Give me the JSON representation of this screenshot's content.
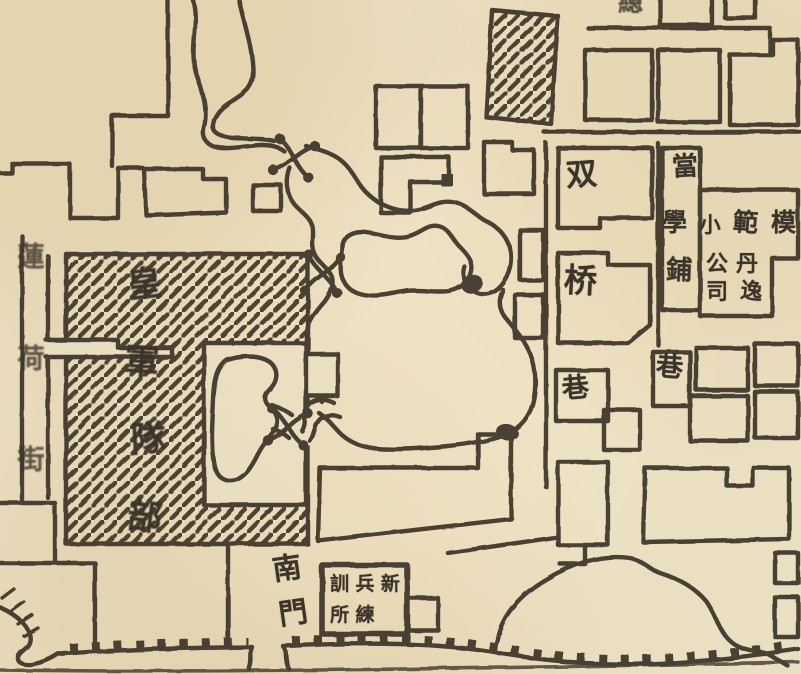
{
  "palette": {
    "paper": "#ebdfc2",
    "ink": "#3e352a"
  },
  "labels": {
    "army_hq": {
      "chars": [
        "皇",
        "軍",
        "隊",
        "部"
      ]
    },
    "shuang": {
      "char": "双"
    },
    "qiao": {
      "char": "桥"
    },
    "dang": {
      "char": "當"
    },
    "pu": {
      "char": "鋪"
    },
    "school": {
      "chars": [
        "學",
        "小",
        "範",
        "模"
      ]
    },
    "company": {
      "rows": [
        [
          "公",
          "丹"
        ],
        [
          "司",
          "逸"
        ]
      ]
    },
    "lane_a": {
      "char": "巷"
    },
    "lane_b": {
      "char": "巷"
    },
    "south_gate": {
      "chars": [
        "南",
        "門"
      ]
    },
    "training": {
      "rows": [
        [
          "訓",
          "兵",
          "新"
        ],
        [
          "所",
          "練",
          ""
        ]
      ]
    },
    "street_w": {
      "chars": [
        "蓮",
        "荷",
        "街"
      ]
    },
    "edge_top": {
      "char": "總"
    }
  }
}
